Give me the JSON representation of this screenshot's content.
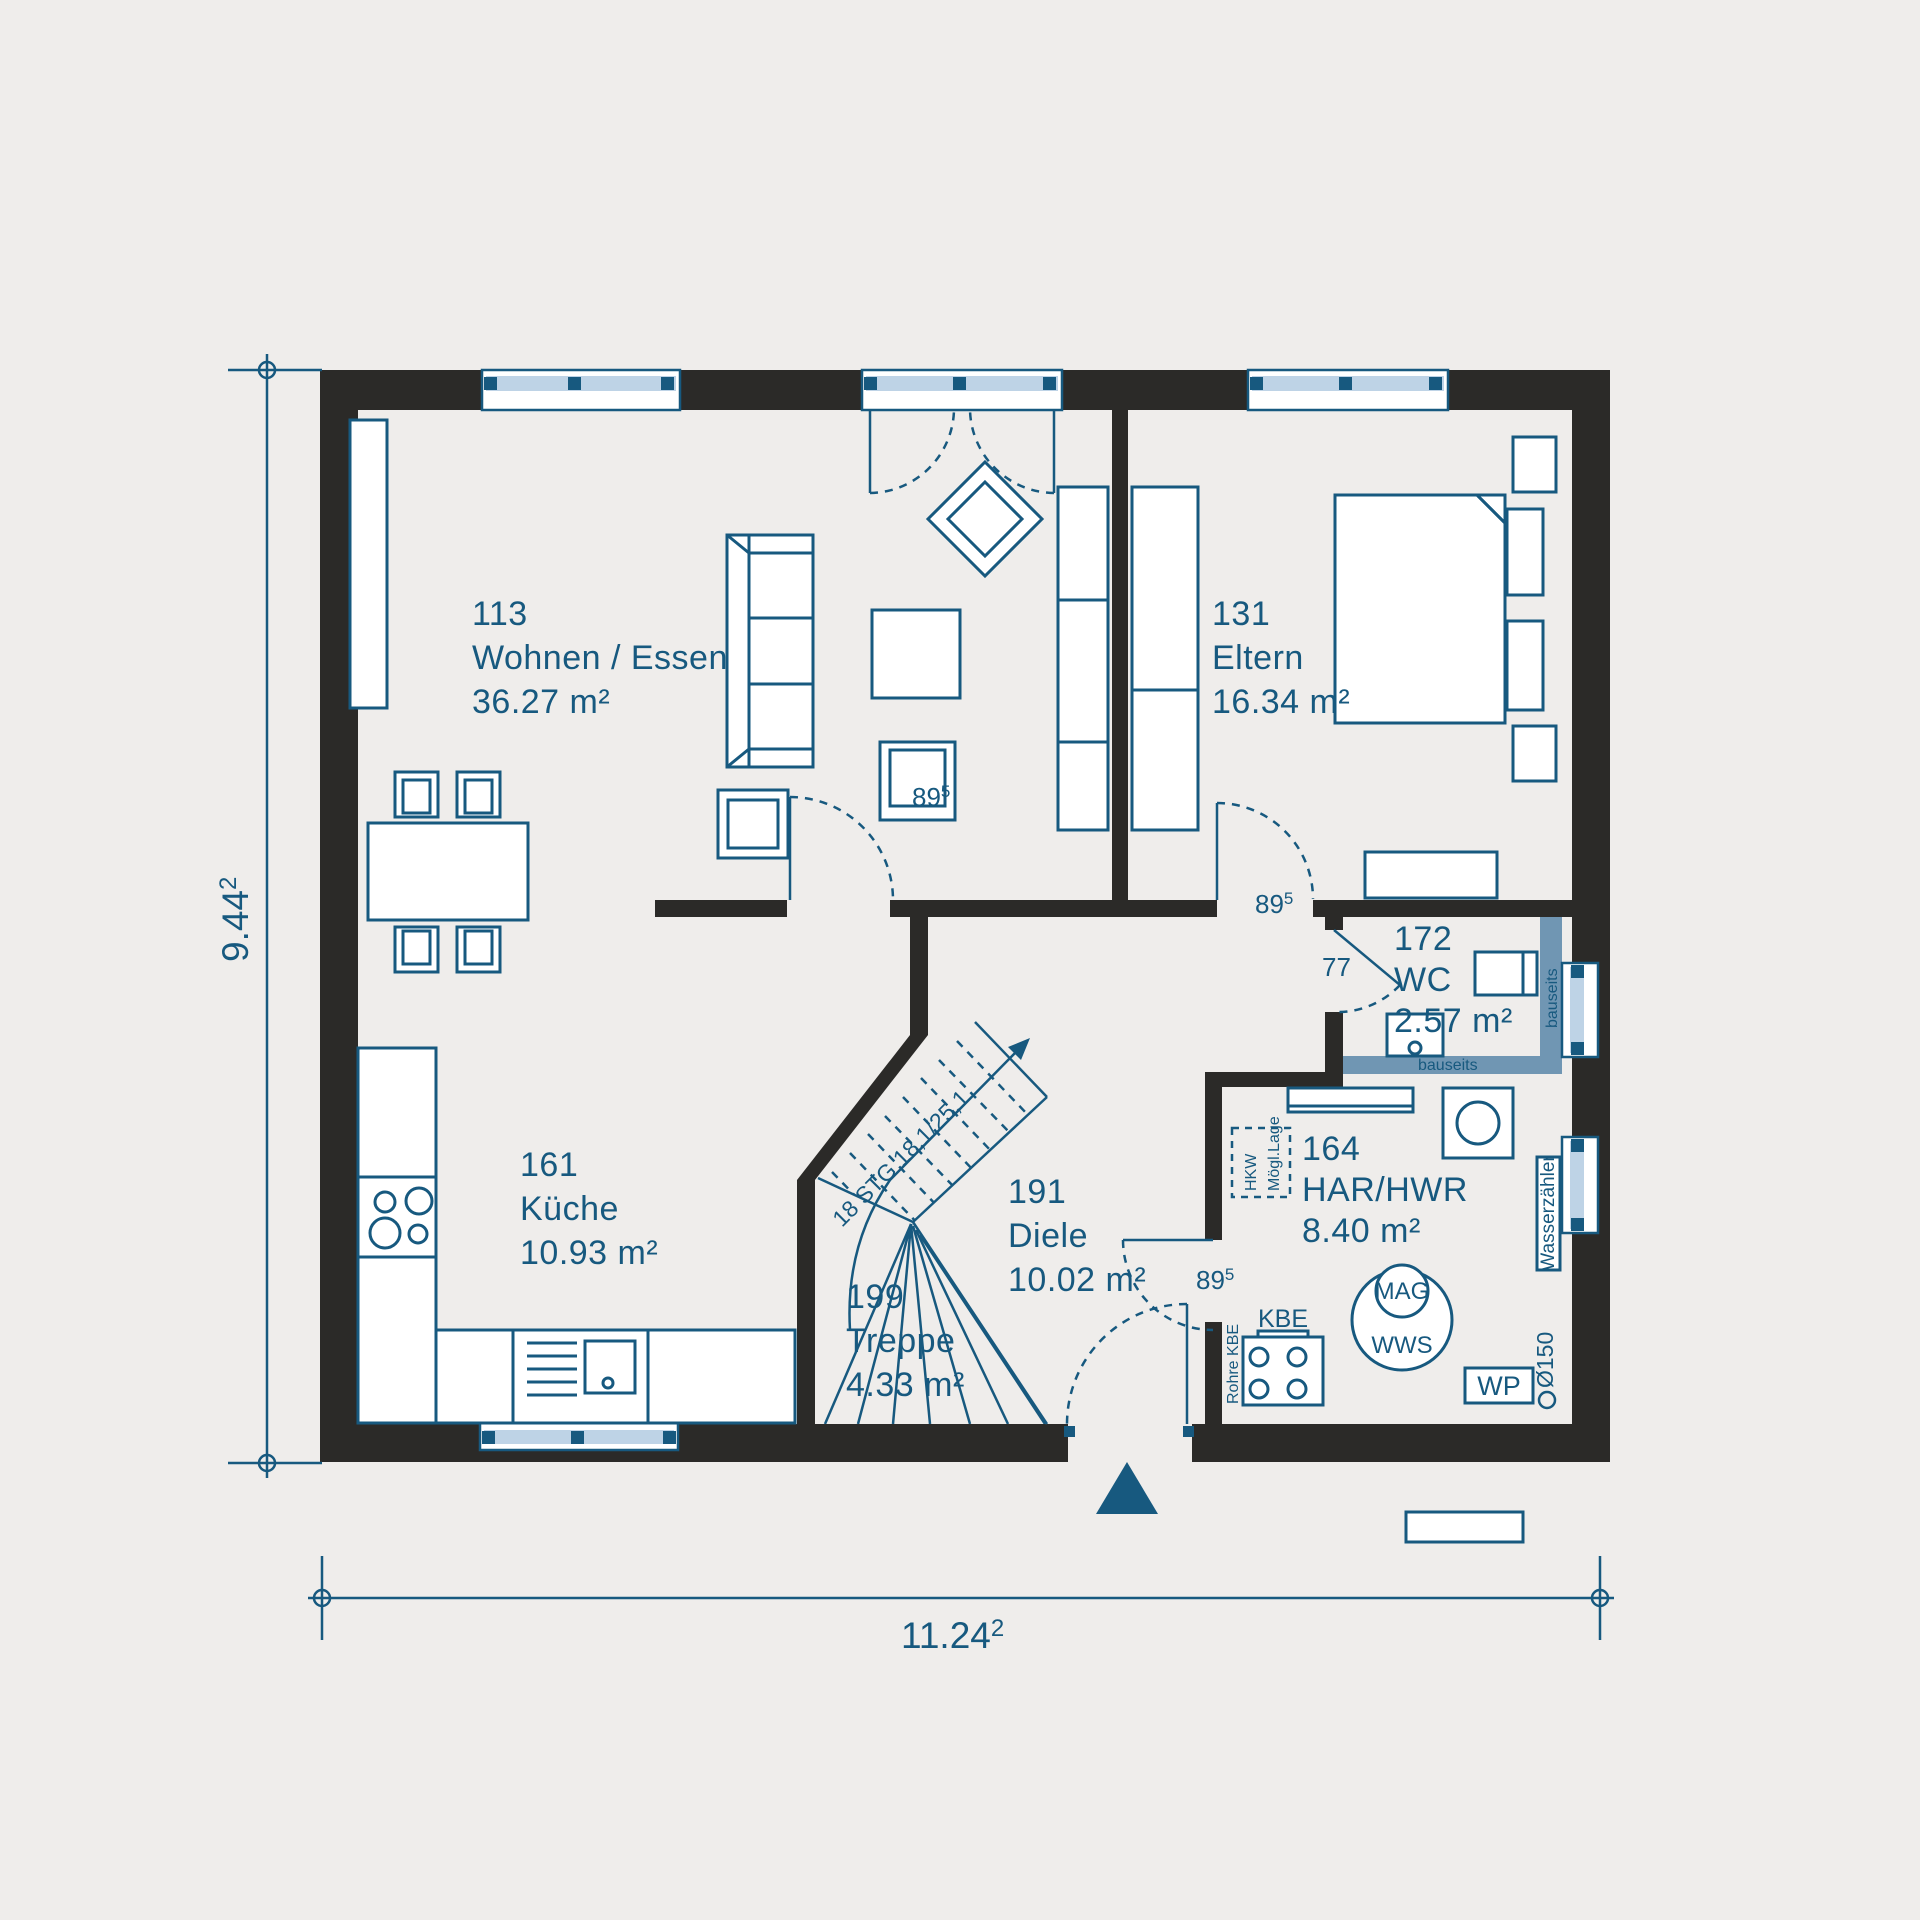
{
  "rooms": {
    "wohnen": {
      "number": "113",
      "name": "Wohnen / Essen",
      "area": "36.27 m²"
    },
    "eltern": {
      "number": "131",
      "name": "Eltern",
      "area": "16.34 m²"
    },
    "kueche": {
      "number": "161",
      "name": "Küche",
      "area": "10.93 m²"
    },
    "wc": {
      "number": "172",
      "name": "WC",
      "area": "2.57 m²"
    },
    "har": {
      "number": "164",
      "name": "HAR/HWR",
      "area": "8.40 m²"
    },
    "diele": {
      "number": "191",
      "name": "Diele",
      "area": "10.02 m²"
    },
    "treppe": {
      "number": "199",
      "name": "Treppe",
      "area": "4.33 m²"
    }
  },
  "dimensions": {
    "width": {
      "value": "11.24",
      "sup": "2"
    },
    "height": {
      "value": "9.44",
      "sup": "2"
    }
  },
  "doors": {
    "standard": {
      "value": "89",
      "sup": "5"
    },
    "wc_width": "77"
  },
  "stairs": {
    "note": "18 STG 18,1/25,1"
  },
  "tech": {
    "hkw_line1": "HKW",
    "hkw_line2": "Mögl.Lage",
    "wasserzaehler": "Wasserzähler",
    "kbe": "KBE",
    "rohre_kbe": "Rohre KBE",
    "mag": "MAG",
    "wws": "WWS",
    "wp": "WP",
    "d150": "Ø150",
    "bauseits": "bauseits"
  },
  "colors": {
    "wall": "#2b2a28",
    "line_blue": "#17597f",
    "glass_blue": "#bed3e6",
    "bauseits_blue": "#7096b3",
    "background": "#efedeb"
  }
}
